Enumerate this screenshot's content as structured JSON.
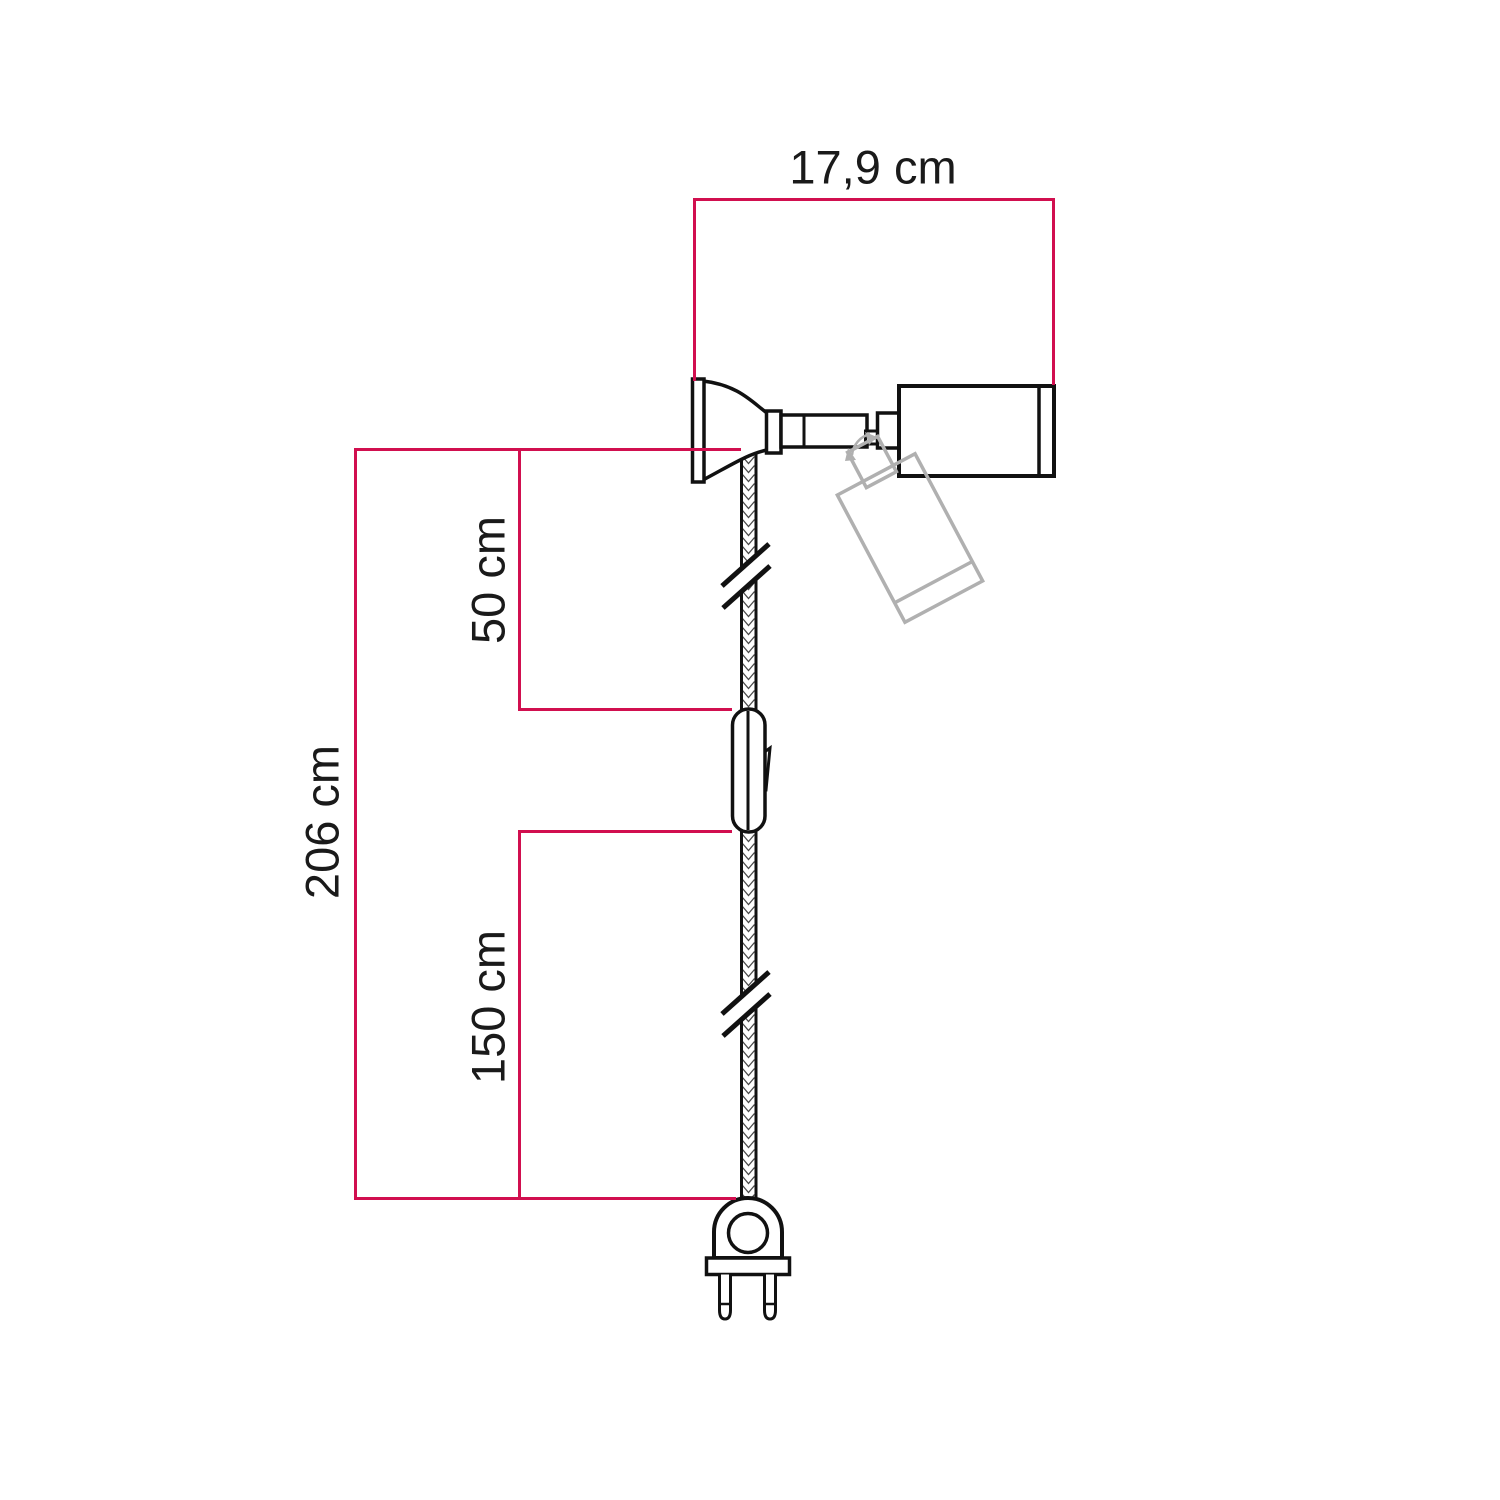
{
  "labels": {
    "width": "17,9 cm",
    "upper_section": "50 cm",
    "total_height": "206 cm",
    "lower_section": "150 cm"
  },
  "colors": {
    "dimension_line": "#d10f4f",
    "outline": "#111111",
    "ghost": "#b0b0b0",
    "background": "#ffffff"
  }
}
